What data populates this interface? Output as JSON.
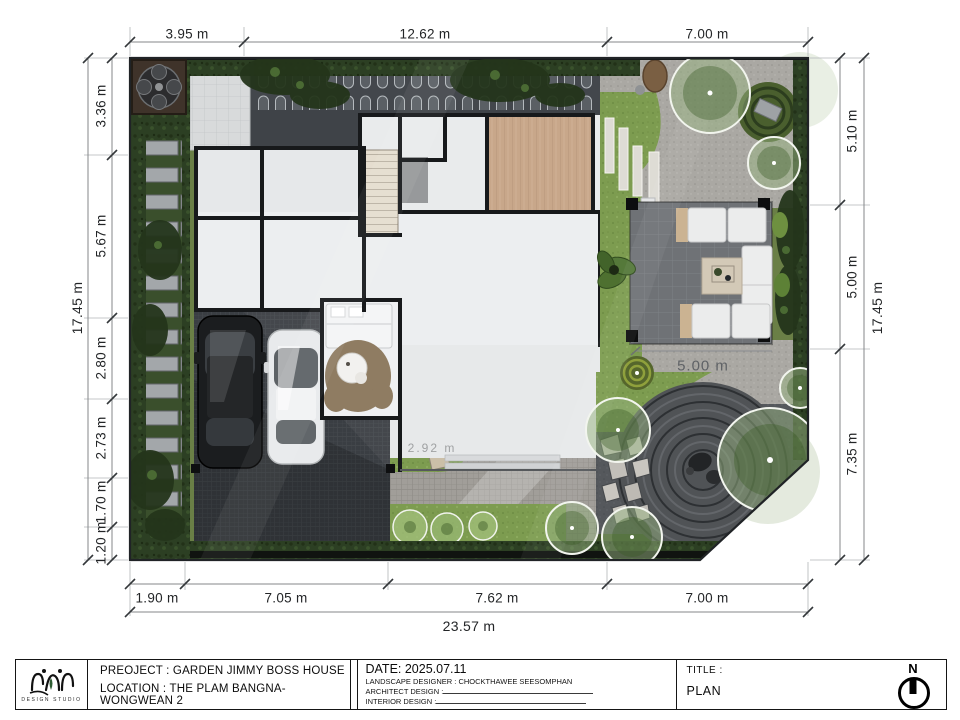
{
  "dims": {
    "top": [
      "3.95 m",
      "12.62 m",
      "7.00 m"
    ],
    "left": [
      "3.36 m",
      "5.67 m",
      "2.80 m",
      "2.73 m",
      "1.70 m",
      "1.20 m"
    ],
    "left_total": "17.45 m",
    "right": [
      "5.10 m",
      "5.00 m",
      "7.35 m"
    ],
    "right_total": "17.45 m",
    "bottom": [
      "1.90 m",
      "7.05 m",
      "7.62 m",
      "7.00 m"
    ],
    "bottom_total": "23.57 m"
  },
  "plan": {
    "inner_dim_label": "5.00 m",
    "faint_dim_label": "2.92 m"
  },
  "title_block": {
    "project": "PREOJECT : GARDEN JIMMY BOSS HOUSE",
    "location": "LOCATION : THE PLAM BANGNA-WONGWEAN 2",
    "date": "DATE: 2025.07.11",
    "landscape_designer": "LANDSCAPE DESIGNER : CHOCKTHAWEE SEESOMPHAN",
    "architect_design": "ARCHITECT DESIGN :",
    "interior_design": "INTERIOR DESIGN :",
    "title_label": "TITLE :",
    "title_value": "PLAN",
    "north_letter": "N",
    "logo_caption": "DESIGN STUDIO"
  },
  "colors": {
    "hedge_green": "#2c3f23",
    "lawn_green": "#7d9c50",
    "paver_dark": "#3a3e43",
    "gravel_light": "#aaa8a3",
    "zen_gravel": "#55585c",
    "wood_floor": "#c8a78a",
    "wall_black": "#17191b",
    "house_floor": "#eceef0"
  }
}
